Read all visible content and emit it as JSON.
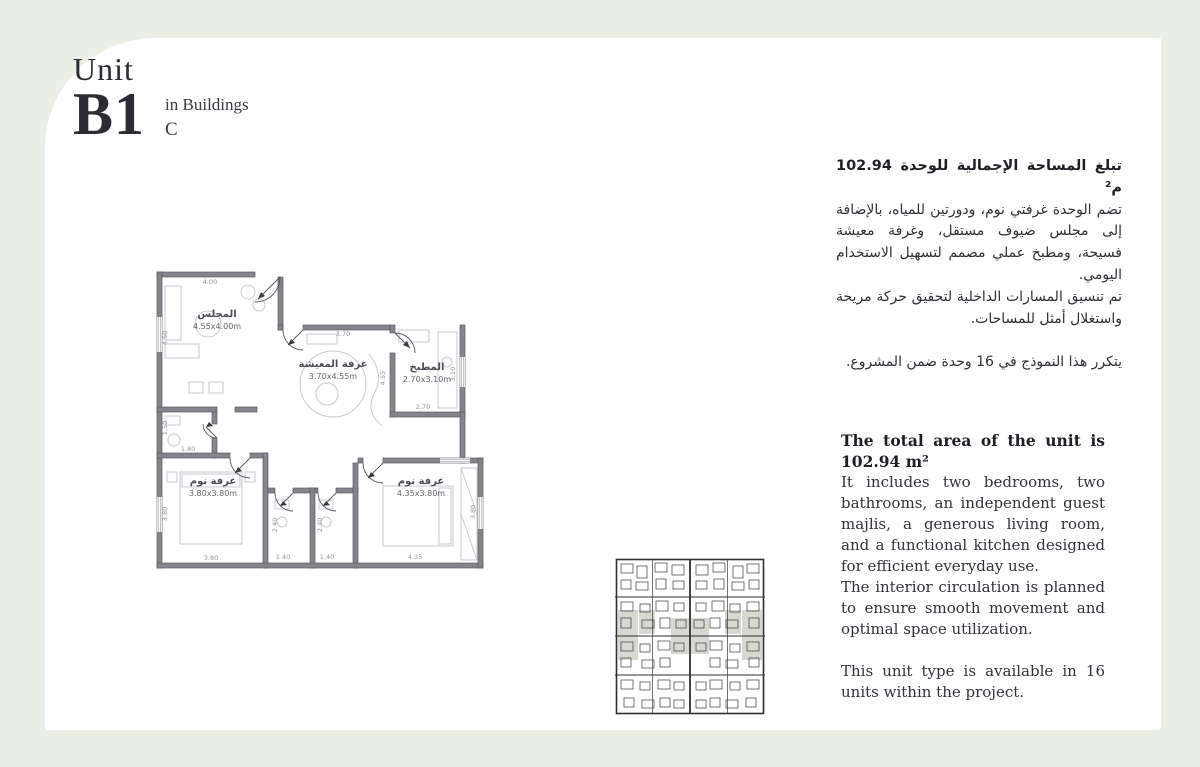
{
  "page": {
    "background": "#ebeee4",
    "card_background": "#ffffff",
    "accent_text": "#2c2c33"
  },
  "header": {
    "unit_label": "Unit",
    "unit_code": "B1",
    "in_buildings": "in Buildings",
    "building_letter": "C"
  },
  "arabic": {
    "area_line": "تبلغ المساحة الإجمالية للوحدة 102.94 م²",
    "description": "تضم الوحدة غرفتي نوم، ودورتين للمياه، بالإضافة إلى مجلس ضيوف مستقل، وغرفة معيشة فسيحة، ومطبخ عملي مصمم لتسهيل الاستخدام اليومي.",
    "circulation": "تم تنسيق المسارات الداخلية لتحقيق حركة مريحة واستغلال أمثل للمساحات.",
    "availability": "يتكرر هذا النموذج في 16 وحدة ضمن المشروع."
  },
  "english": {
    "area_line": "The total area of the unit is 102.94 m²",
    "description": "It includes two bedrooms, two bathrooms, an independent guest majlis, a generous living room, and a functional kitchen designed for efficient everyday use.",
    "circulation": "The interior circulation is planned to ensure smooth movement and optimal space utilization.",
    "availability": "This unit type is available in 16 units within the project."
  },
  "floor_plan": {
    "rooms": [
      {
        "name": "المجلس",
        "size": "4.55x4.00m"
      },
      {
        "name": "غرفة المعيشة",
        "size": "3.70x4.55m"
      },
      {
        "name": "المطبخ",
        "size": "2.70x3.10m"
      },
      {
        "name": "غرفة نوم",
        "size": "3.80x3.80m"
      },
      {
        "name": "غرفة نوم",
        "size": "4.35x3.80m"
      }
    ],
    "dims": {
      "majlis_w": "4.00",
      "majlis_h": "4.50",
      "living_w": "3.70",
      "living_h": "4.55",
      "kitchen_h": "3.10",
      "kitchen_w": "2.70",
      "hall_bath_h": "1.50",
      "hall_bath_w": "1.80",
      "bed1_h": "3.80",
      "bed1_w": "3.80",
      "bath1_h": "2.40",
      "bath1_w": "1.40",
      "bath2_h": "2.40",
      "bath2_w": "1.40",
      "bed2_w": "4.35",
      "bed2_h": "3.80"
    }
  }
}
